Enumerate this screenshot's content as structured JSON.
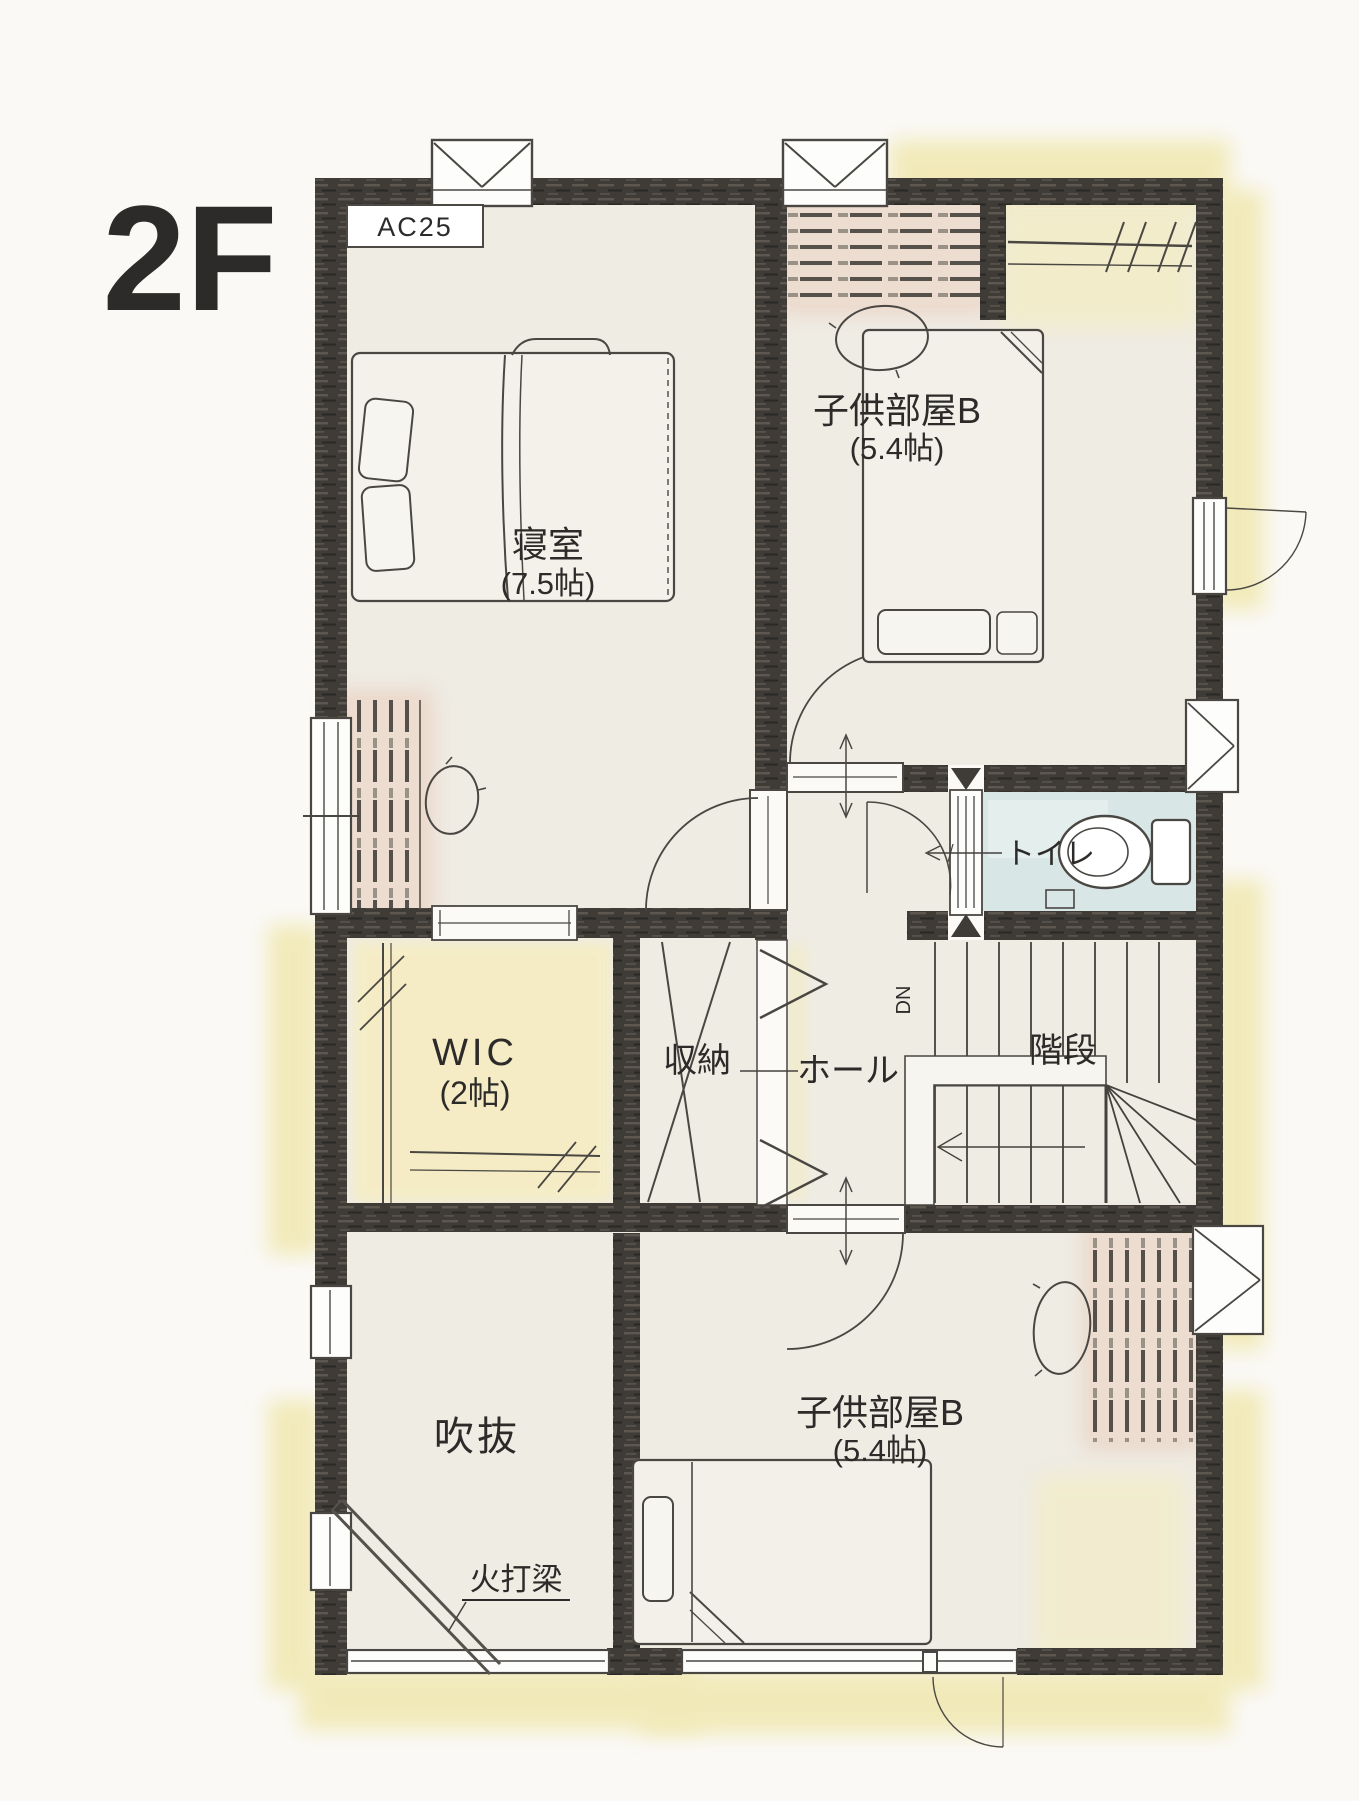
{
  "page": {
    "floor_label": "2F"
  },
  "plan": {
    "ac_label": "AC25",
    "rooms": {
      "bedroom": {
        "name": "寝室",
        "size": "(7.5帖)"
      },
      "kids_room_top": {
        "name": "子供部屋B",
        "size": "(5.4帖)"
      },
      "kids_room_bottom": {
        "name": "子供部屋B",
        "size": "(5.4帖)"
      },
      "wic": {
        "name": "WIC",
        "size": "(2帖)"
      },
      "storage": {
        "name": "収納"
      },
      "hall": {
        "name": "ホール"
      },
      "stairs": {
        "name": "階段",
        "down_label": "DN"
      },
      "toilet": {
        "name": "トイレ"
      },
      "void": {
        "name": "吹抜"
      }
    },
    "annotations": {
      "beam": "火打梁"
    },
    "colors": {
      "wall": "#3f3c38",
      "floor": "#efece4",
      "halo_yellow": "#f0e7ae",
      "closet_pink": "#edddd0",
      "toilet_blue": "#d8e6e6",
      "wic_yellow": "#f5edc4",
      "line": "#45423e"
    }
  }
}
